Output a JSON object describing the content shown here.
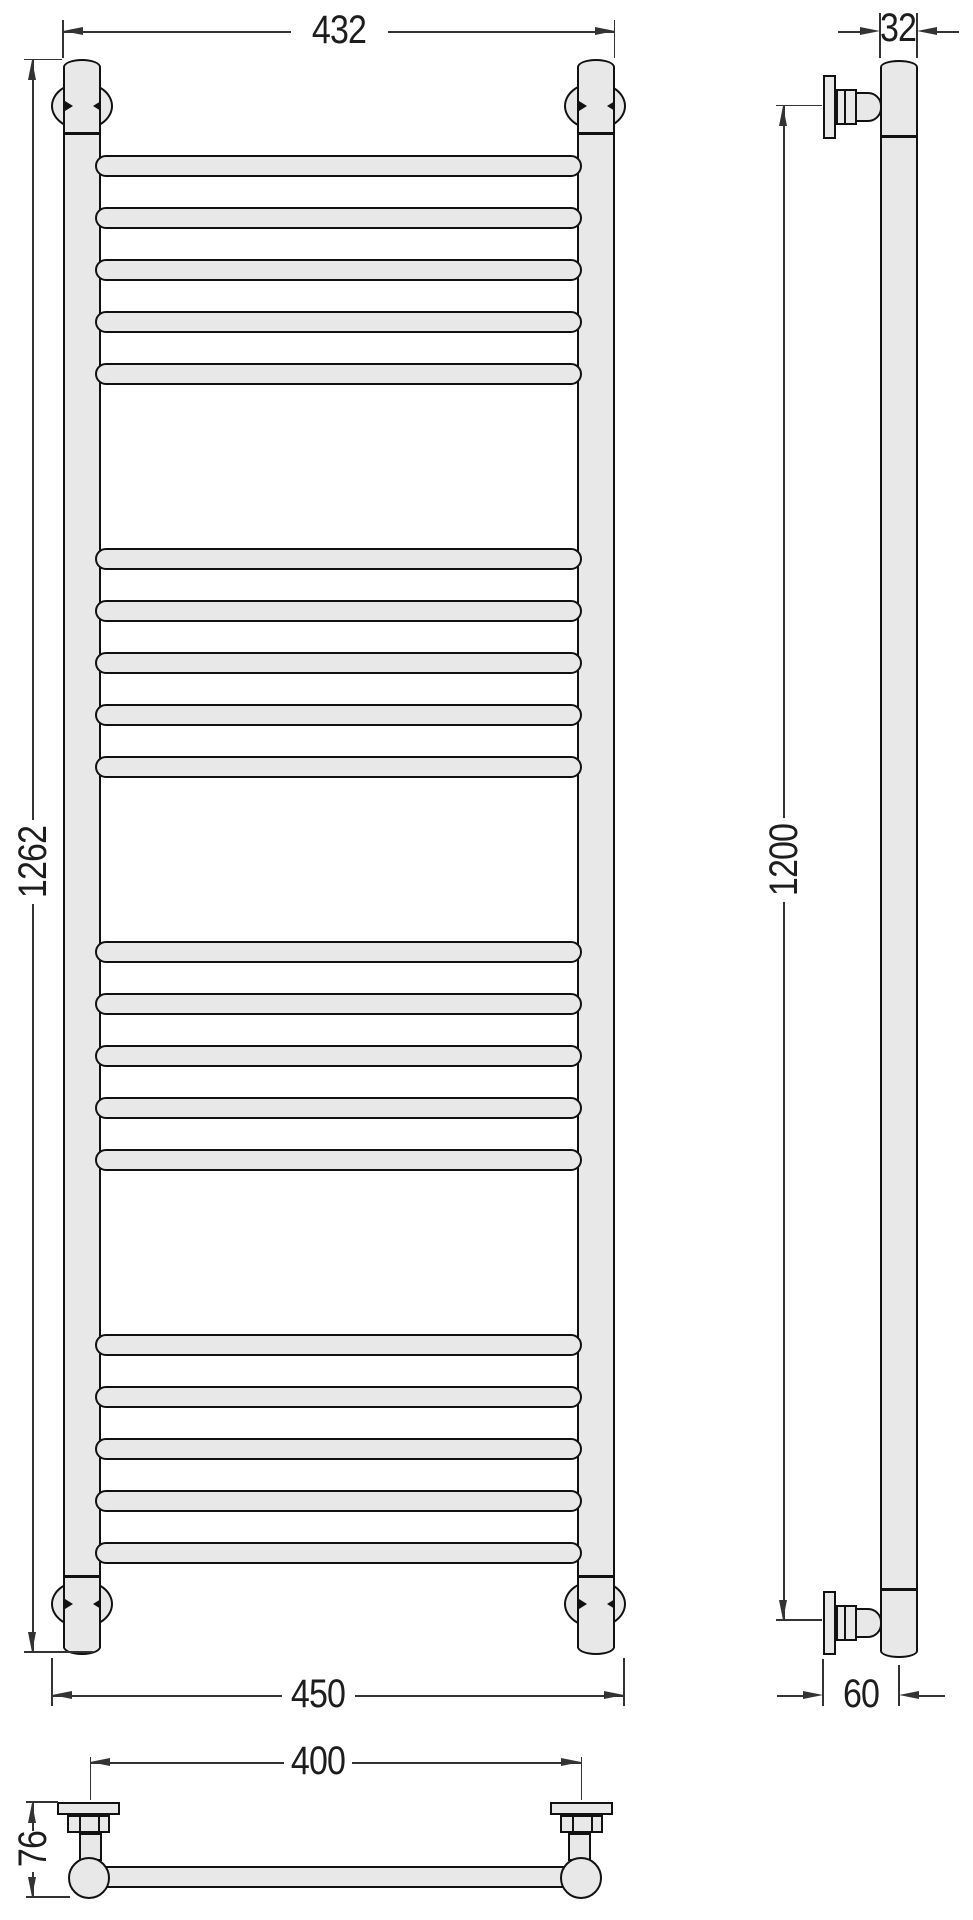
{
  "drawing": {
    "subject": "ladder towel rail radiator - three-view technical drawing",
    "front_view": {
      "rung_groups": 4,
      "rungs_per_group": 5,
      "total_rungs": 20
    },
    "dimensions": {
      "width_top": "432",
      "overall_height": "1262",
      "width_bottom": "450",
      "tube_diameter": "32",
      "bracket_height": "1200",
      "wall_offset": "60",
      "bracket_spacing": "400",
      "depth": "76"
    },
    "colors": {
      "fill": "#e8e8e8",
      "outline": "#111111",
      "dimension": "#333333",
      "background": "#ffffff"
    }
  }
}
